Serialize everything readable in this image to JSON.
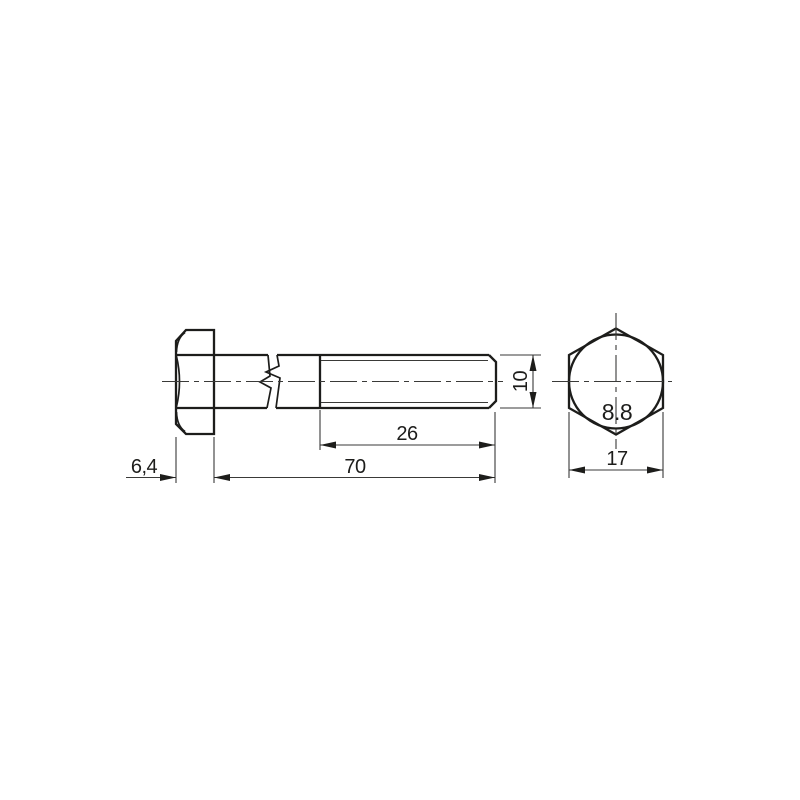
{
  "drawing": {
    "kind": "technical drawing",
    "subject": "hex head bolt - side view and end view",
    "grade_marking": "8.8",
    "dimensions": {
      "head_height": "6,4",
      "shank_length": "70",
      "thread_length": "26",
      "diameter": "10",
      "across_flats": "17"
    },
    "colors": {
      "line": "#1d1d1b",
      "background": "#ffffff"
    }
  }
}
